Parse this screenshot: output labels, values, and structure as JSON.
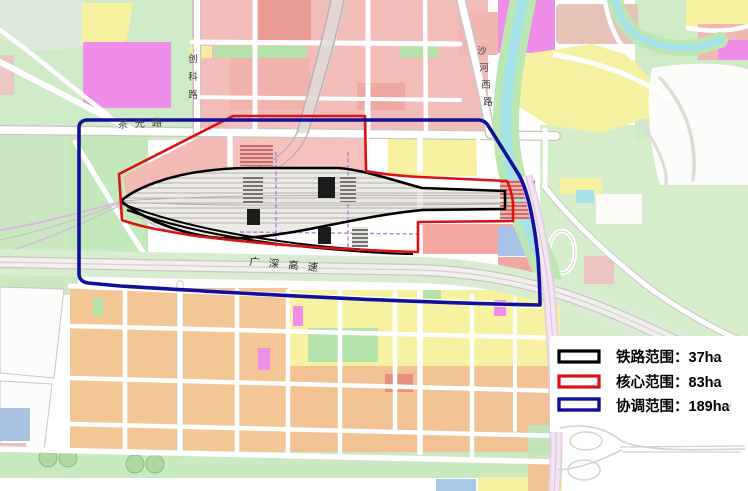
{
  "map": {
    "road_labels": {
      "chuangke_road": {
        "name": "创科路",
        "chars": [
          "创",
          "科",
          "路"
        ]
      },
      "chaguang_road": {
        "name": "茶光路"
      },
      "shahexi_road": {
        "name": "沙河西路",
        "chars": [
          "沙",
          "河",
          "西",
          "路"
        ]
      },
      "guangshen_expressway": {
        "name": "广深高速"
      }
    },
    "legend": {
      "items": [
        {
          "id": "railway-scope",
          "label": "铁路范围：37ha",
          "color": "#000000"
        },
        {
          "id": "core-scope",
          "label": "核心范围：83ha",
          "color": "#dd1111"
        },
        {
          "id": "coordination-scope",
          "label": "协调范围：189ha",
          "color": "#10109b"
        }
      ],
      "return_mark": "↵"
    },
    "colors": {
      "boundary_railway": "#000000",
      "boundary_core": "#dd1111",
      "boundary_coordination": "#10109b",
      "residential_pink": "#f2bdb9",
      "commercial_red": "#eb9b95",
      "industrial_yellow": "#f6f2a2",
      "green_space": "#c9e9c0",
      "mixed_orange": "#f3c795",
      "special_magenta": "#ee8ee8",
      "water_cyan": "#a6e3e8",
      "facility_blue": "#a8c3e6",
      "track_gray": "#b6b2ae"
    }
  }
}
